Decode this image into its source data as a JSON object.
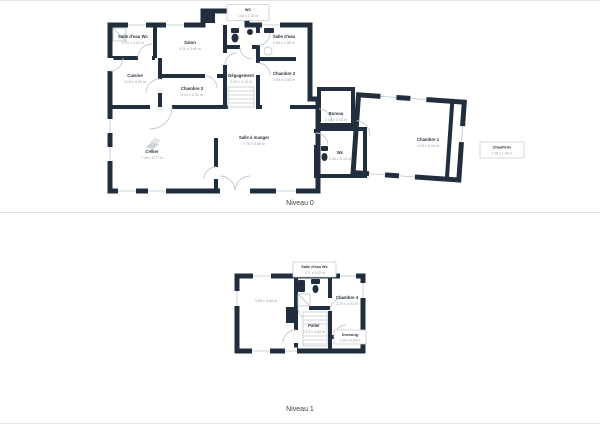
{
  "colors": {
    "wall": "#212e3d",
    "room_name_text": "#2a3440",
    "dimension_text": "#9aa1aa",
    "fixture_line": "#c4cad0",
    "divider": "#e0e0e0",
    "background": "#ffffff"
  },
  "levels": [
    {
      "label": "Niveau 0",
      "rooms": {
        "wc_top": {
          "name": "WC",
          "dims": "1.64 x 1.32 m",
          "boxed": true
        },
        "salle_deau_wc": {
          "name": "Salle d'eau Wc",
          "dims": "2.91 x 2.63 m"
        },
        "salon": {
          "name": "Salon",
          "dims": "4.11 x 3.80 m"
        },
        "salle_deau": {
          "name": "Salle d'eau",
          "dims": "2.95 x 1.88 m"
        },
        "cuisine": {
          "name": "Cuisine",
          "dims": "3.18 x 3.60 m"
        },
        "chambre3": {
          "name": "Chambre 3",
          "dims": "3.13 x 2.51 m"
        },
        "degagement": {
          "name": "Dégagement",
          "dims": "2.29 x 4.13 m"
        },
        "chambre2": {
          "name": "Chambre 2",
          "dims": "2.95 x 3.56 m"
        },
        "cellier": {
          "name": "Cellier",
          "dims": "7.48 x 5.77 m"
        },
        "salle_a_manger": {
          "name": "Salle à manger",
          "dims": "7.70 x 5.86 m"
        },
        "bureau": {
          "name": "Bureau",
          "dims": "2.34 x 3.10 m"
        },
        "wc_bas": {
          "name": "Wc",
          "dims": "2.34 x 2.12 m"
        },
        "chambre1": {
          "name": "Chambre 1",
          "dims": "4.23 x 5.44 m"
        },
        "chaufferie": {
          "name": "Chaufferie",
          "dims": "1.05 x 1.44 m",
          "boxed": true
        }
      }
    },
    {
      "label": "Niveau 1",
      "rooms": {
        "salle_deau_wc": {
          "name": "Salle d'eau Wc",
          "dims": "1.71 x 3.62 m",
          "boxed": true
        },
        "room_left": {
          "name": "",
          "dims": "3.85 x 5.68 m"
        },
        "chambre4": {
          "name": "Chambre 4",
          "dims": "2.79 x 4.01 m"
        },
        "palier": {
          "name": "Palier",
          "dims": "2.73 x 3.65 m"
        },
        "dressing": {
          "name": "Dressing",
          "dims": "2.30 x 0.93 m",
          "boxed": true
        }
      }
    }
  ]
}
